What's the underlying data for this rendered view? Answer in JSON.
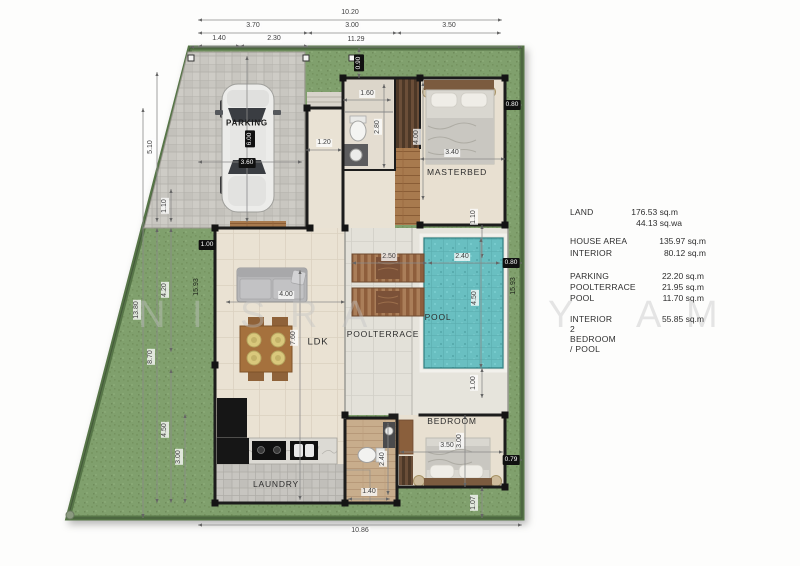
{
  "watermark": {
    "letters": [
      {
        "c": "N",
        "x": 138
      },
      {
        "c": "I",
        "x": 192
      },
      {
        "c": "S",
        "x": 240
      },
      {
        "c": "R",
        "x": 290
      },
      {
        "c": "A",
        "x": 342
      },
      {
        "c": "Y",
        "x": 548
      },
      {
        "c": "A",
        "x": 636
      },
      {
        "c": "M",
        "x": 686
      }
    ],
    "y": 294
  },
  "plan": {
    "rooms": [
      {
        "id": "parking",
        "label": "PARKING",
        "x": 247,
        "y": 123
      },
      {
        "id": "masterbed",
        "label": "MASTERBED",
        "x": 457,
        "y": 172
      },
      {
        "id": "ldk",
        "label": "LDK",
        "x": 318,
        "y": 342
      },
      {
        "id": "poolterrace",
        "label": "POOLTERRACE",
        "x": 383,
        "y": 334
      },
      {
        "id": "pool",
        "label": "POOL",
        "x": 438,
        "y": 317
      },
      {
        "id": "bedroom",
        "label": "BEDROOM",
        "x": 452,
        "y": 421
      },
      {
        "id": "laundry",
        "label": "LAUNDRY",
        "x": 276,
        "y": 484
      }
    ],
    "dimensions": [
      {
        "t": "10.20",
        "x": 350,
        "y": 13
      },
      {
        "t": "3.70",
        "x": 253,
        "y": 26
      },
      {
        "t": "3.00",
        "x": 352,
        "y": 26
      },
      {
        "t": "3.50",
        "x": 449,
        "y": 26
      },
      {
        "t": "1.40",
        "x": 219,
        "y": 39
      },
      {
        "t": "2.30",
        "x": 274,
        "y": 39
      },
      {
        "t": "11.29",
        "x": 356,
        "y": 40
      },
      {
        "t": "13.80",
        "x": 137,
        "y": 310,
        "rot": 1
      },
      {
        "t": "5.10",
        "x": 151,
        "y": 147,
        "rot": 1
      },
      {
        "t": "1.10",
        "x": 165,
        "y": 206,
        "rot": 1
      },
      {
        "t": "4.20",
        "x": 165,
        "y": 290,
        "rot": 1
      },
      {
        "t": "8.70",
        "x": 151,
        "y": 357,
        "rot": 1
      },
      {
        "t": "4.50",
        "x": 165,
        "y": 430,
        "rot": 1
      },
      {
        "t": "3.00",
        "x": 179,
        "y": 457,
        "rot": 1
      },
      {
        "t": "15.93",
        "x": 197,
        "y": 287,
        "rot": 1,
        "green": 1
      },
      {
        "t": "15.93",
        "x": 514,
        "y": 286,
        "rot": 1,
        "green": 1
      },
      {
        "t": "1.00",
        "x": 207,
        "y": 245,
        "box": 1
      },
      {
        "t": "0.90",
        "x": 359,
        "y": 63,
        "box": 1,
        "rot": 1
      },
      {
        "t": "0.80",
        "x": 512,
        "y": 105,
        "box": 1
      },
      {
        "t": "0.80",
        "x": 511,
        "y": 263,
        "box": 1
      },
      {
        "t": "0.79",
        "x": 511,
        "y": 460,
        "box": 1
      },
      {
        "t": "1.07",
        "x": 474,
        "y": 503,
        "rot": 1
      },
      {
        "t": "1.00",
        "x": 474,
        "y": 383,
        "rot": 1
      },
      {
        "t": "1.10",
        "x": 474,
        "y": 217,
        "rot": 1
      },
      {
        "t": "6.00",
        "x": 250,
        "y": 139,
        "box": 1,
        "rot": 1
      },
      {
        "t": "3.60",
        "x": 247,
        "y": 163,
        "box": 1
      },
      {
        "t": "1.60",
        "x": 367,
        "y": 94
      },
      {
        "t": "2.80",
        "x": 378,
        "y": 127,
        "rot": 1
      },
      {
        "t": "4.00",
        "x": 417,
        "y": 137,
        "rot": 1
      },
      {
        "t": "3.40",
        "x": 452,
        "y": 153
      },
      {
        "t": "1.20",
        "x": 324,
        "y": 143
      },
      {
        "t": "2.50",
        "x": 389,
        "y": 257
      },
      {
        "t": "2.40",
        "x": 462,
        "y": 257
      },
      {
        "t": "4.50",
        "x": 475,
        "y": 298,
        "rot": 1
      },
      {
        "t": "4.00",
        "x": 286,
        "y": 295
      },
      {
        "t": "7.60",
        "x": 294,
        "y": 338,
        "rot": 1
      },
      {
        "t": "3.50",
        "x": 447,
        "y": 446
      },
      {
        "t": "3.00",
        "x": 460,
        "y": 441,
        "rot": 1
      },
      {
        "t": "2.40",
        "x": 383,
        "y": 459,
        "rot": 1
      },
      {
        "t": "1.40",
        "x": 369,
        "y": 492
      },
      {
        "t": "10.86",
        "x": 360,
        "y": 531
      }
    ]
  },
  "summary": {
    "rows": [
      {
        "label": "LAND",
        "value": "176.53 sq.m",
        "y": 212,
        "vr": 678
      },
      {
        "label": "",
        "value": "44.13 sq.wa",
        "y": 223,
        "vr": 682
      },
      {
        "label": "HOUSE AREA",
        "value": "135.97 sq.m",
        "y": 241,
        "vr": 706
      },
      {
        "label": "INTERIOR",
        "value": "80.12 sq.m",
        "y": 253,
        "vr": 706
      },
      {
        "label": "PARKING",
        "value": "22.20 sq.m",
        "y": 276,
        "vr": 704
      },
      {
        "label": "POOLTERRACE",
        "value": "21.95 sq.m",
        "y": 287,
        "vr": 704
      },
      {
        "label": "POOL",
        "value": "11.70 sq.m",
        "y": 298,
        "vr": 704
      },
      {
        "label": "INTERIOR",
        "value": "55.85 sq.m",
        "y": 319,
        "vr": 704
      }
    ],
    "tagline": "2 BEDROOM  / POOL"
  },
  "colors": {
    "grass": "#80a06d",
    "water": "#69bfc1",
    "wall": "#1c1c1c",
    "wood": "#a87a4e",
    "floor_beige": "#eae2d3"
  }
}
